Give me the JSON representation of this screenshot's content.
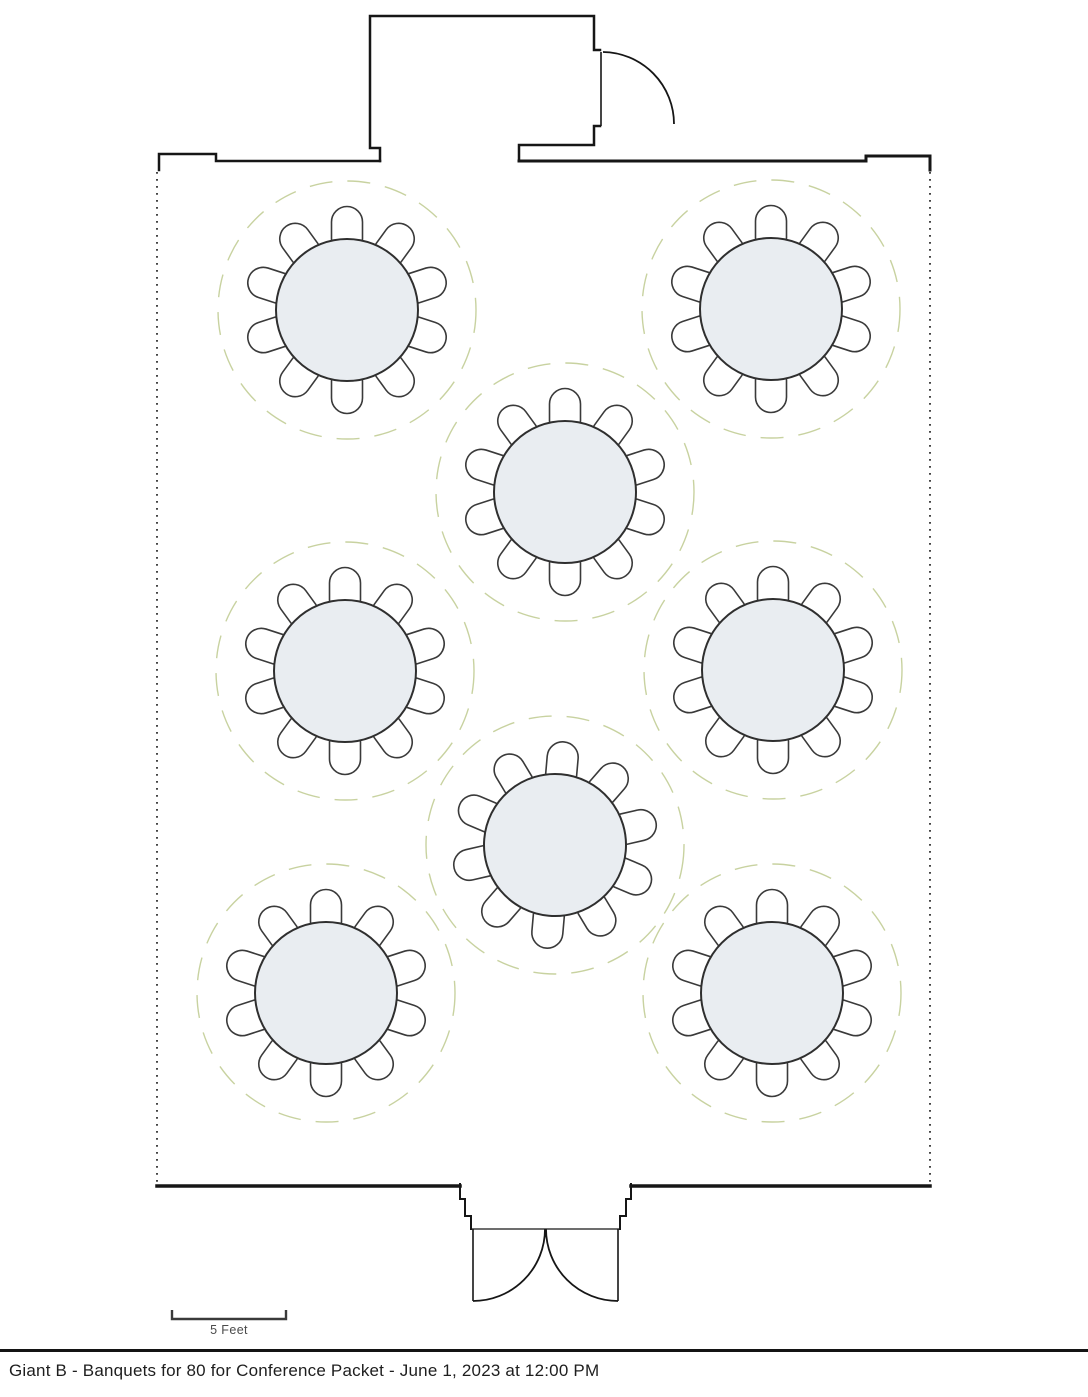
{
  "footer": {
    "title": "Giant B - Banquets for 80 for Conference Packet - June 1, 2023 at 12:00 PM"
  },
  "scale_bar": {
    "label": "5 Feet",
    "feet": 5
  },
  "diagram": {
    "type": "banquet-floor-plan",
    "room_name": "Giant B",
    "layout_name": "Banquets for 80",
    "total_seats": 80,
    "table_count": 8,
    "seats_per_table": 10,
    "table_radius": 71,
    "clearance_radius": 129,
    "tables": [
      {
        "id": "table-1",
        "cx": 347,
        "cy": 310,
        "seats": 10,
        "rotation": 0
      },
      {
        "id": "table-2",
        "cx": 771,
        "cy": 309,
        "seats": 10,
        "rotation": 0
      },
      {
        "id": "table-3",
        "cx": 565,
        "cy": 492,
        "seats": 10,
        "rotation": 0
      },
      {
        "id": "table-4",
        "cx": 345,
        "cy": 671,
        "seats": 10,
        "rotation": 0
      },
      {
        "id": "table-5",
        "cx": 773,
        "cy": 670,
        "seats": 10,
        "rotation": 0
      },
      {
        "id": "table-6",
        "cx": 555,
        "cy": 845,
        "seats": 10,
        "rotation": 5
      },
      {
        "id": "table-7",
        "cx": 326,
        "cy": 993,
        "seats": 10,
        "rotation": 0
      },
      {
        "id": "table-8",
        "cx": 772,
        "cy": 993,
        "seats": 10,
        "rotation": 0
      }
    ],
    "doors": [
      {
        "id": "vestibule-door",
        "type": "single-swing",
        "location": "top-vestibule-right"
      },
      {
        "id": "main-entry-door",
        "type": "double-swing",
        "location": "bottom-center"
      }
    ]
  },
  "colors": {
    "wall": "#161616",
    "outline": "#3a3a3a",
    "table_fill": "#e9edf1",
    "table_stroke": "#2f2f2f",
    "clearance_dash": "#c8d2a0"
  }
}
